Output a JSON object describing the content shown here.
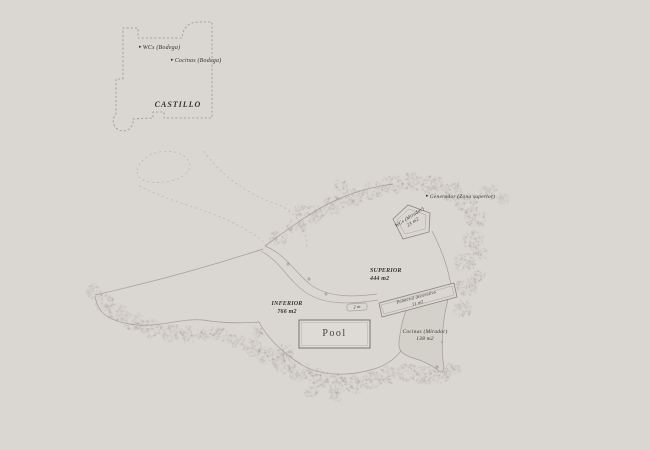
{
  "colors": {
    "background": "#dad6d1",
    "line": "#a29b93",
    "dark_line": "#746e66",
    "text": "#38342e",
    "vegetation": "#7d766d",
    "area_fill": "#d4d0ca",
    "pool_fill": "#dedad5"
  },
  "icons": {
    "arrow_right": "▸"
  },
  "castle": {
    "name": "CASTILLO",
    "annotations": [
      {
        "label": "WCs (Bodega)"
      },
      {
        "label": "Cocinas (Bodega)"
      }
    ]
  },
  "zones": {
    "superior": {
      "name": "SUPERIOR",
      "area": "444 m2"
    },
    "inferior": {
      "name": "INFERIOR",
      "area": "766 m2"
    }
  },
  "features": {
    "pool": {
      "label": "Pool"
    },
    "wcs_mirador": {
      "name": "WCs (Mirador)",
      "area": "23 m2"
    },
    "palmeral": {
      "name": "Palmeral decorativo",
      "area": "11 m2"
    },
    "cocinas_mirador": {
      "name": "Cocinas (Mirador)",
      "area": "138 m2"
    },
    "generador": {
      "label": "Generador (Zona superior)"
    },
    "path_width_marker": {
      "label": "2 m"
    }
  }
}
